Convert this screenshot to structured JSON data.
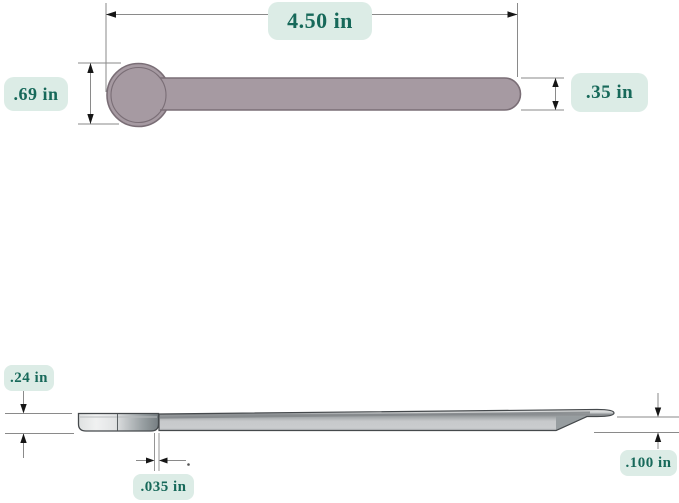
{
  "colors": {
    "background": "#ffffff",
    "label_bg": "#dcece6",
    "label_text": "#17695a",
    "part_fill": "#a69aa2",
    "part_outline": "#7a6e76",
    "profile_outline": "#45494c",
    "dim_line": "#8a8a8a",
    "arrow": "#161616"
  },
  "top_view": {
    "dimensions": {
      "length": {
        "label": "4.50 in"
      },
      "head_diameter": {
        "label": ".69 in"
      },
      "handle_width": {
        "label": ".35 in"
      }
    }
  },
  "side_view": {
    "dimensions": {
      "head_depth": {
        "label": ".24 in"
      },
      "edge_thickness": {
        "label": ".035 in"
      },
      "tip_thickness": {
        "label": ".100 in"
      }
    }
  }
}
